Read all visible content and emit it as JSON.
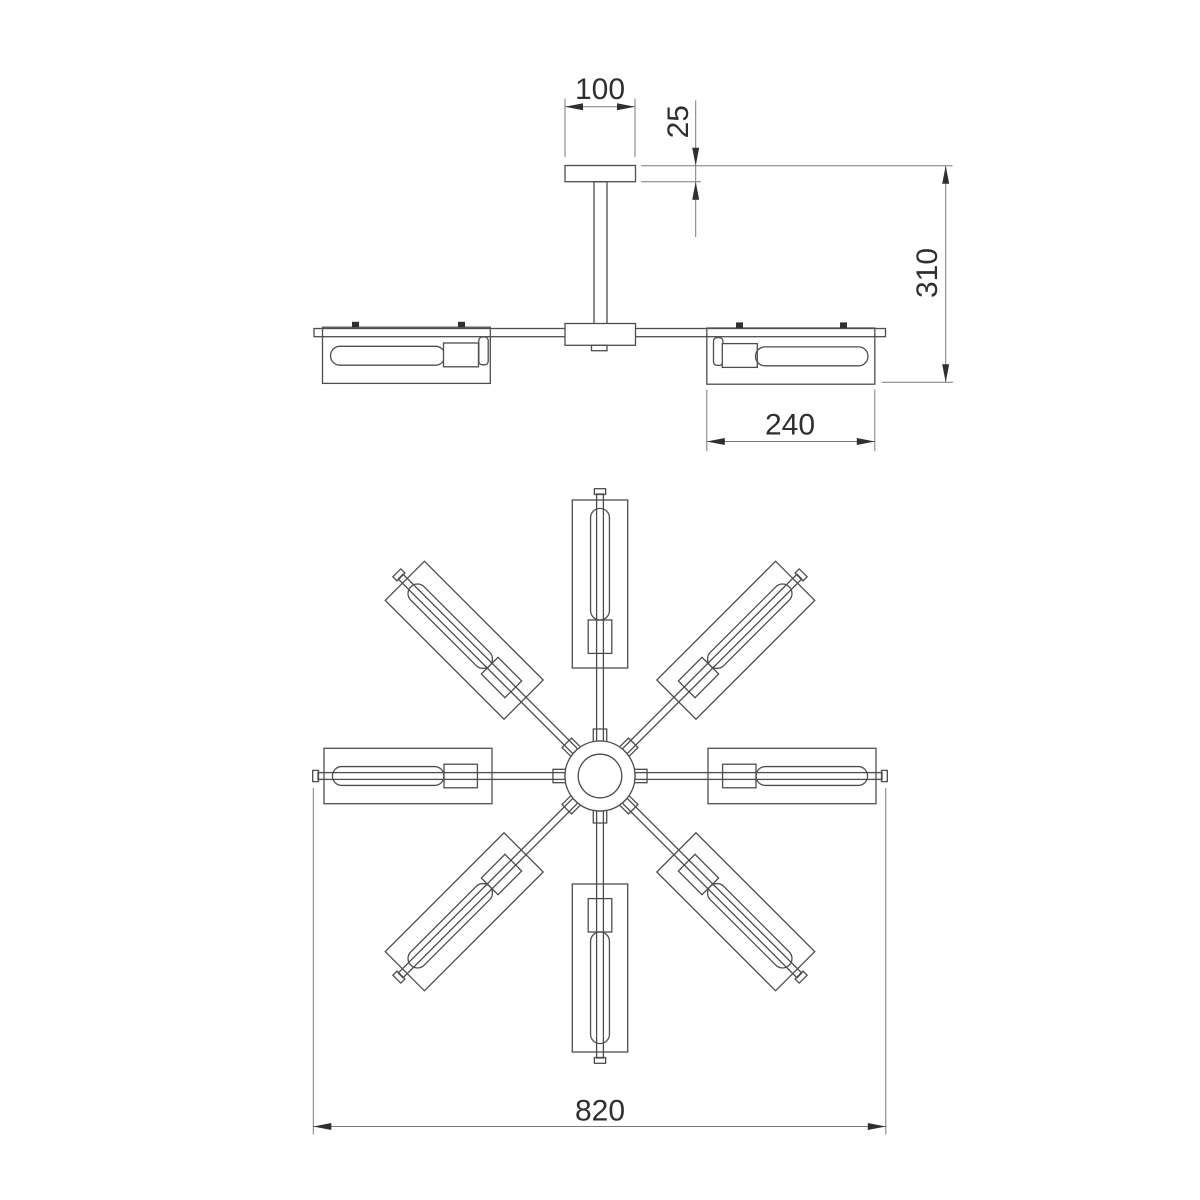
{
  "drawing": {
    "type": "technical-dimension-drawing",
    "units": "mm",
    "background_color": "#ffffff",
    "line_color": "#4d4d4d",
    "dimension_line_color": "#7a7a7a",
    "text_color": "#2f2f2f",
    "side_view": {
      "canopy_width": "100",
      "canopy_height": "25",
      "overall_height": "310",
      "shade_length": "240"
    },
    "top_view": {
      "overall_width": "820",
      "arm_count": 8
    }
  }
}
